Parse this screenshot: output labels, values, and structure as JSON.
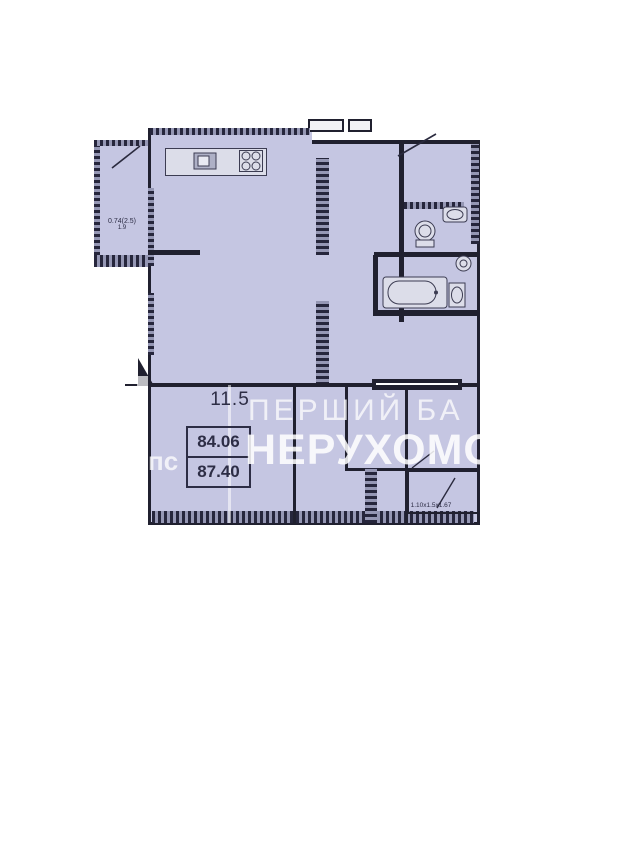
{
  "floor_plan": {
    "room_area_label": "11.5",
    "area_summary": {
      "upper": "84.06",
      "lower": "87.40"
    },
    "balcony_area": {
      "line1": "0.74(2.5)",
      "line2": "1.9"
    },
    "storage_dimensions": "1.10x1.5x1.67",
    "colors": {
      "floor": "#c5c6e2",
      "walls": "#20202f",
      "window_hatch_light": "#9597b4",
      "background": "#ffffff",
      "label_text": "#2d2d45",
      "watermark": "#ffffff"
    }
  },
  "watermark": {
    "line1": "ПЕРШИЙ БА",
    "line2": "НЕРУХОМОС",
    "fragment": "пс"
  }
}
